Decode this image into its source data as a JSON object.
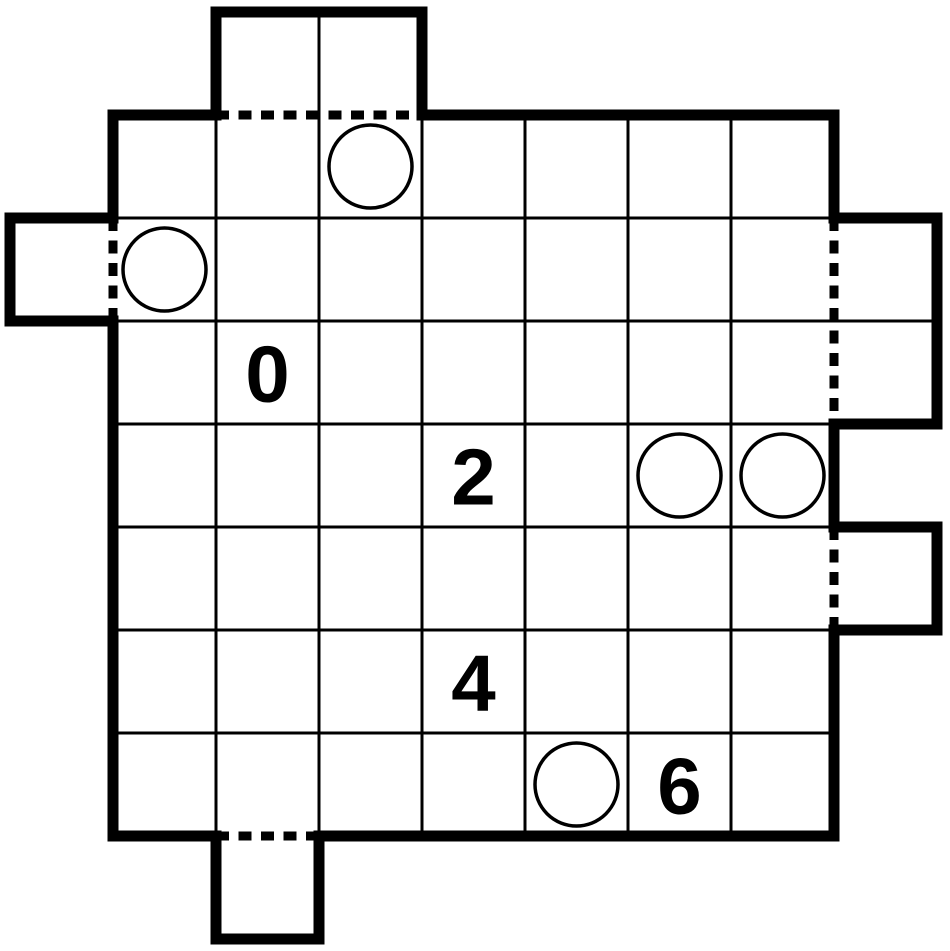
{
  "canvas": {
    "width": 950,
    "height": 951,
    "background": "#ffffff"
  },
  "grid": {
    "x": 113,
    "y": 115,
    "rows": 7,
    "cols": 7,
    "cell_size": 103
  },
  "style": {
    "line_color": "#000000",
    "thin_width": 3,
    "thick_width": 11,
    "dash_width": 9,
    "dash_array": "13 9.5",
    "circle_radius": 41.5,
    "circle_stroke_width": 3.5,
    "circle_fill": "#ffffff",
    "number_font_size": 80,
    "number_color": "#000000"
  },
  "outline_points": [
    [
      113,
      115
    ],
    [
      216,
      115
    ],
    [
      216,
      12
    ],
    [
      422,
      12
    ],
    [
      422,
      115
    ],
    [
      834,
      115
    ],
    [
      834,
      218
    ],
    [
      937,
      218
    ],
    [
      937,
      424
    ],
    [
      834,
      424
    ],
    [
      834,
      527
    ],
    [
      937,
      527
    ],
    [
      937,
      630
    ],
    [
      834,
      630
    ],
    [
      834,
      836
    ],
    [
      319,
      836
    ],
    [
      319,
      939
    ],
    [
      216,
      939
    ],
    [
      216,
      836
    ],
    [
      113,
      836
    ],
    [
      113,
      321
    ],
    [
      10,
      321
    ],
    [
      10,
      218
    ],
    [
      113,
      218
    ]
  ],
  "dashed_openings": [
    {
      "name": "top-bump-opening",
      "from": [
        216,
        115
      ],
      "to": [
        422,
        115
      ]
    },
    {
      "name": "left-bump-opening",
      "from": [
        113,
        218
      ],
      "to": [
        113,
        321
      ]
    },
    {
      "name": "right-upper-bump-opening",
      "from": [
        834,
        218
      ],
      "to": [
        834,
        424
      ]
    },
    {
      "name": "right-lower-bump-opening",
      "from": [
        834,
        527
      ],
      "to": [
        834,
        630
      ]
    },
    {
      "name": "bottom-bump-opening",
      "from": [
        216,
        836
      ],
      "to": [
        319,
        836
      ]
    }
  ],
  "extra_grid_lines": [
    {
      "name": "top-bump-divider",
      "from": [
        319,
        12
      ],
      "to": [
        319,
        115
      ]
    },
    {
      "name": "right-upper-bump-divider",
      "from": [
        834,
        321
      ],
      "to": [
        937,
        321
      ]
    }
  ],
  "bumps": [
    {
      "side": "top",
      "index": 1,
      "span": 2
    },
    {
      "side": "left",
      "index": 1,
      "span": 1
    },
    {
      "side": "right",
      "index": 1,
      "span": 2
    },
    {
      "side": "right",
      "index": 4,
      "span": 1
    },
    {
      "side": "bottom",
      "index": 1,
      "span": 1
    }
  ],
  "circles": [
    {
      "row": 0,
      "col": 2
    },
    {
      "row": 1,
      "col": 0
    },
    {
      "row": 3,
      "col": 5
    },
    {
      "row": 3,
      "col": 6
    },
    {
      "row": 6,
      "col": 4
    }
  ],
  "clues": [
    {
      "row": 2,
      "col": 1,
      "value": "0"
    },
    {
      "row": 3,
      "col": 3,
      "value": "2"
    },
    {
      "row": 5,
      "col": 3,
      "value": "4"
    },
    {
      "row": 6,
      "col": 5,
      "value": "6"
    }
  ]
}
